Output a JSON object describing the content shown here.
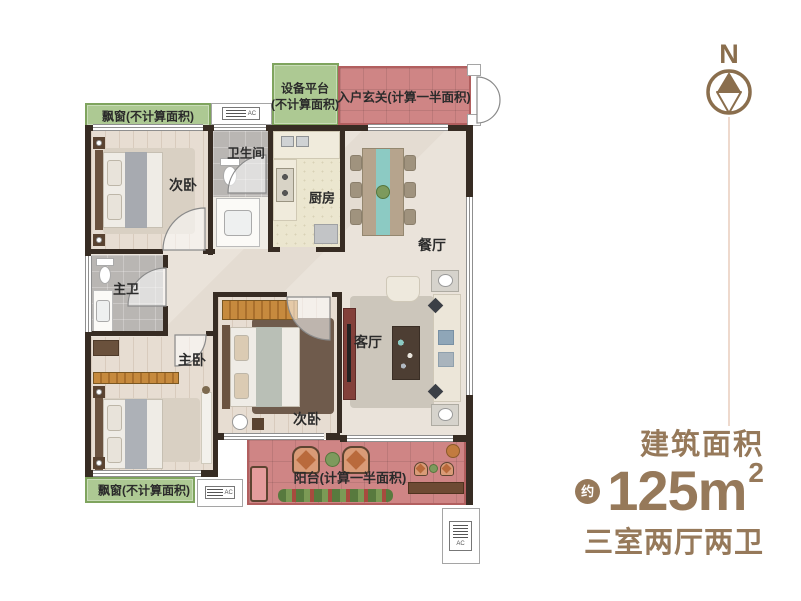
{
  "plan": {
    "zones": {
      "bay_top": {
        "label": "飘窗(不计算面积)"
      },
      "equip": {
        "line1": "设备平台",
        "line2": "(不计算面积)"
      },
      "entry": {
        "label": "入户玄关(计算一半面积)"
      },
      "bay_bottom": {
        "label": "飘窗(不计算面积)"
      },
      "balcony": {
        "label": "阳台(计算一半面积)"
      }
    },
    "rooms": {
      "bed1": {
        "label": "次卧"
      },
      "bath": {
        "label": "卫生间"
      },
      "kitchen": {
        "label": "厨房"
      },
      "dining": {
        "label": "餐厅"
      },
      "master_bath": {
        "label": "主卫"
      },
      "master": {
        "label": "主卧"
      },
      "bed2": {
        "label": "次卧"
      },
      "living": {
        "label": "客厅"
      }
    },
    "ac_unit": {
      "label": "AC"
    }
  },
  "compass": {
    "north": "N"
  },
  "info": {
    "area_title": "建筑面积",
    "area_approx": "约",
    "area_value": "125m",
    "area_exponent": "2",
    "layout_text": "三室两厅两卫"
  },
  "colors": {
    "brand_brown": "#96795a",
    "zone_green": "#adc993",
    "zone_red": "#cf8585",
    "wall": "#372c23"
  }
}
